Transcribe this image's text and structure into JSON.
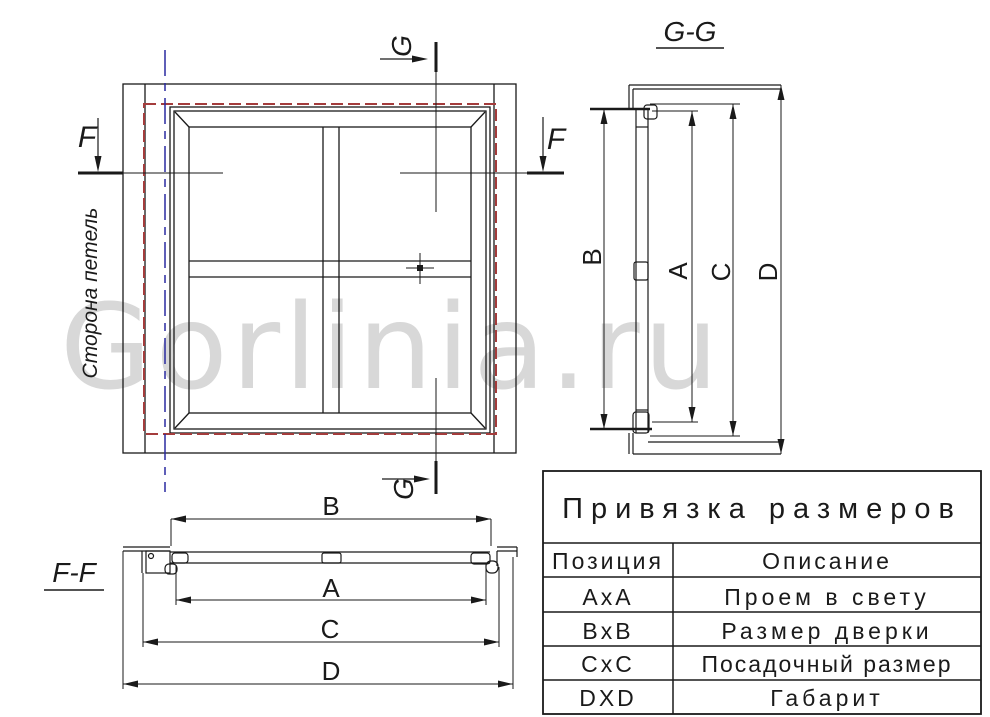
{
  "watermark": "Gorlinia.ru",
  "colors": {
    "line": "#1a1a1a",
    "red_dashed_frame": "#a43c3c",
    "blue_hinge_axis": "#2a2aa0",
    "watermark_gray": "#d8d8d8"
  },
  "front_view": {
    "hinge_side_label": "Сторона петель",
    "section_f_left": "F",
    "section_f_right": "F",
    "section_g_top": "G",
    "section_g_bottom": "G"
  },
  "section_gg": {
    "title": "G-G",
    "dim_b": "B",
    "dim_a": "A",
    "dim_c": "C",
    "dim_d": "D"
  },
  "section_ff": {
    "title": "F-F",
    "dim_b": "B",
    "dim_a": "A",
    "dim_c": "C",
    "dim_d": "D"
  },
  "table": {
    "title": "Привязка размеров",
    "col_position": "Позиция",
    "col_description": "Описание",
    "rows": [
      {
        "position": "AxA",
        "description": "Проем в свету"
      },
      {
        "position": "BxB",
        "description": "Размер дверки"
      },
      {
        "position": "CxC",
        "description": "Посадочный размер"
      },
      {
        "position": "DXD",
        "description": "Габарит"
      }
    ]
  }
}
